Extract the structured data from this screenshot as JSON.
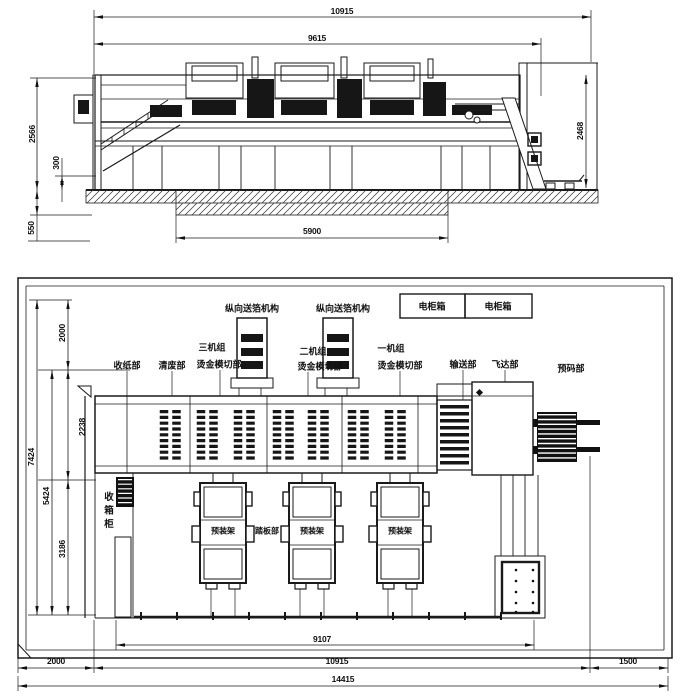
{
  "palette": {
    "ink": "#1a1a1a",
    "paper": "#ffffff",
    "fill_dark": "#161616"
  },
  "side_view": {
    "dims": {
      "overall_length": "10915",
      "body_length": "9615",
      "left_height": "2566",
      "base_height": "300",
      "pit_depth": "550",
      "right_height": "2468",
      "pit_length": "5900"
    }
  },
  "plan_view": {
    "dims": {
      "top_clearance": "2000",
      "body_width": "2238",
      "front_width": "3186",
      "machine_width": "5424",
      "layout_width": "7424",
      "footprint_length": "9107",
      "machine_length": "10915",
      "left_clearance": "2000",
      "right_clearance": "1500",
      "room_length": "14415"
    },
    "labels": {
      "foil_feed": "纵向送箔机构",
      "electric_cabinet": "电柜箱",
      "delivery": "收纸部",
      "waste_removal": "清废部",
      "unit3": "三机组",
      "unit2": "二机组",
      "unit1": "一机组",
      "stamping_diecut": "烫金模切部",
      "conveyor": "输送部",
      "feeder": "飞达部",
      "prestack": "预码部",
      "carton_cabinet": "收箱柜",
      "prefit_rack": "预装架",
      "footboard": "踏板部"
    }
  }
}
